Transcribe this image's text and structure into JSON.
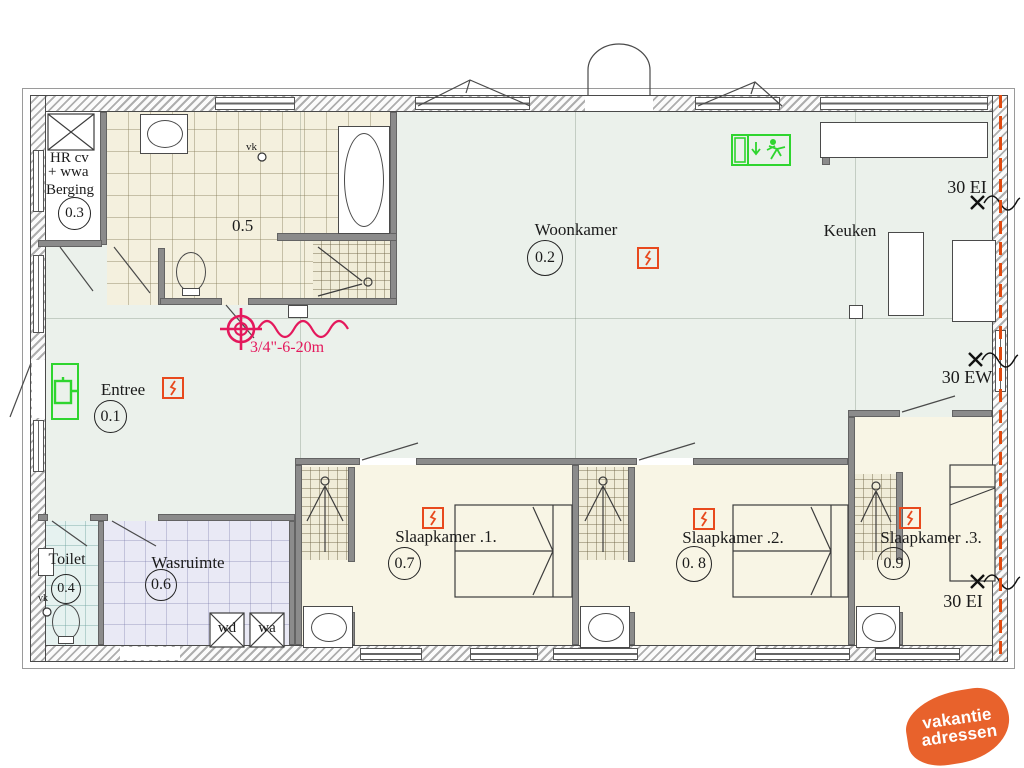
{
  "rooms": {
    "berging": {
      "line1": "HR cv",
      "line2": "+ wwa",
      "label": "Berging",
      "number": "0.3"
    },
    "badkamer": {
      "number": "0.5",
      "vk": "vk"
    },
    "woonkamer": {
      "label": "Woonkamer",
      "number": "0.2"
    },
    "keuken": {
      "label": "Keuken"
    },
    "entree": {
      "label": "Entree",
      "number": "0.1"
    },
    "toilet": {
      "label": "Toilet",
      "number": "0.4",
      "vk": "vk"
    },
    "wasruimte": {
      "label": "Wasruimte",
      "number": "0.6"
    },
    "slaapkamer1": {
      "label": "Slaapkamer .1.",
      "number": "0.7"
    },
    "slaapkamer2": {
      "label": "Slaapkamer .2.",
      "number": "0. 8"
    },
    "slaapkamer3": {
      "label": "Slaapkamer .3.",
      "number": "0.9"
    }
  },
  "fire": {
    "label_top_right": "30 EI",
    "label_mid_right": "30 EW",
    "label_bottom_right": "30 EI",
    "hose_label": "3/4\"-6-20m"
  },
  "appliances": {
    "wd": "wd",
    "wa": "wa"
  },
  "logo": {
    "line1": "vakantie",
    "line2": "adressen"
  },
  "colors": {
    "safety_green": "#2fd52f",
    "detector_red": "#e8491d",
    "fire_line_red": "#e04a10",
    "hose_pink": "#e4185c",
    "logo_orange": "#e8622c",
    "floor_main": "#ebf1eb",
    "floor_bedroom": "#f8f5e5"
  }
}
